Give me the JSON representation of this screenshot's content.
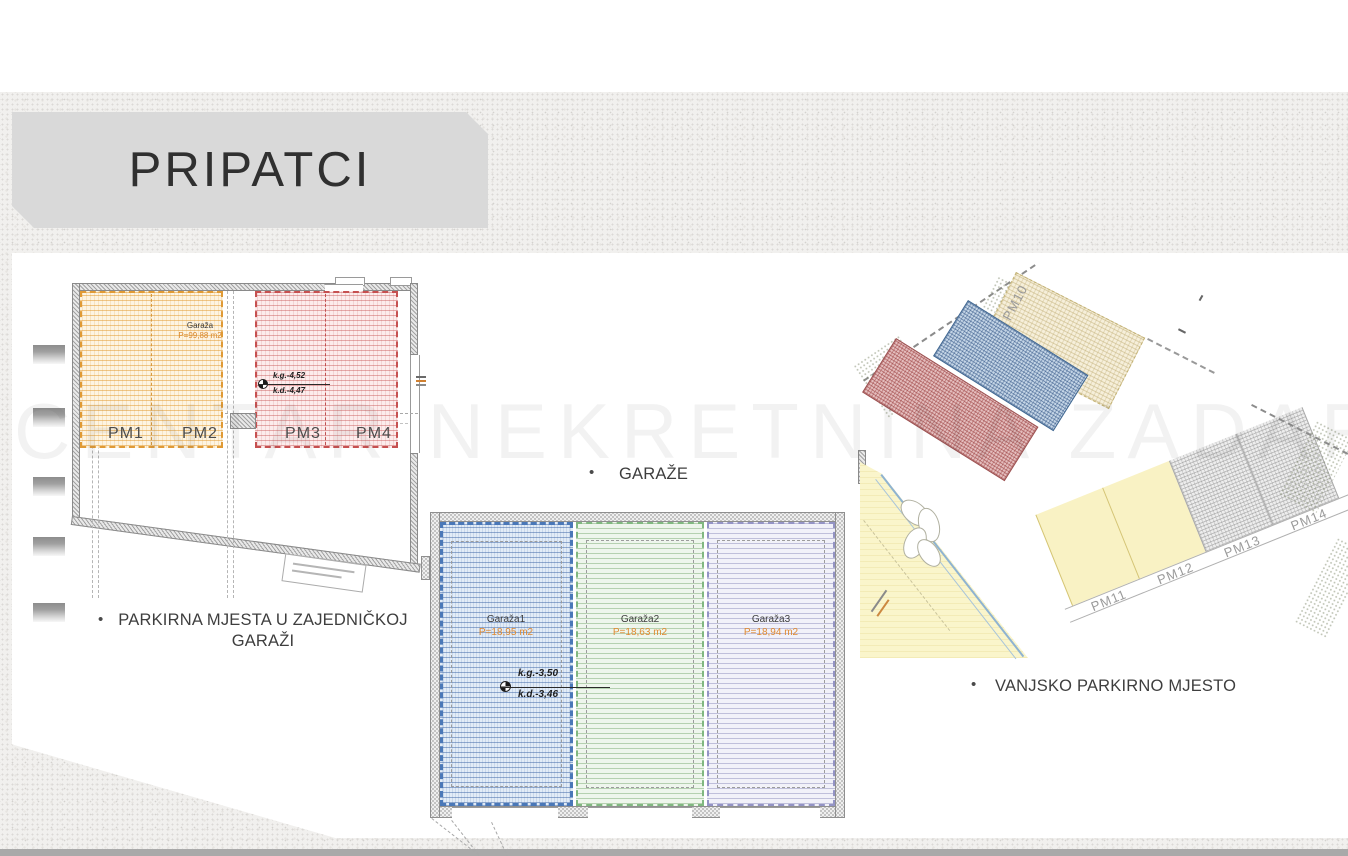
{
  "slide": {
    "title": "PRIPATCI",
    "watermark": "CENTAR NEKRETNINA ZADAR",
    "bullets": [
      {
        "label": "PARKIRNA MJESTA U ZAJEDNIČKOJ GARAŽI"
      },
      {
        "label": "GARAŽE"
      },
      {
        "label": "VANJSKO PARKIRNO MJESTO"
      }
    ]
  },
  "plans": {
    "shared_garage": {
      "name_label": "Garaža",
      "area_label": "P=99,88 m2",
      "level_top": "k.g.-4,52",
      "level_bottom": "k.d.-4,47",
      "stalls": [
        "PM1",
        "PM2",
        "PM3",
        "PM4"
      ]
    },
    "garages": {
      "units": [
        {
          "name": "Garaža1",
          "area": "P=18,95 m2"
        },
        {
          "name": "Garaža2",
          "area": "P=18,63 m2"
        },
        {
          "name": "Garaža3",
          "area": "P=18,94 m2"
        }
      ],
      "level_top": "k.g.-3,50",
      "level_bottom": "k.d.-3,46"
    },
    "outdoor": {
      "stalls": [
        "PM10",
        "PM11",
        "PM12",
        "PM13",
        "PM14"
      ]
    }
  },
  "colors": {
    "title_bg": "#d9d9d9",
    "zone_orange": "#e09a35",
    "zone_red": "#c65050",
    "zone_blue": "#4a78b8",
    "zone_green": "#80b880",
    "zone_lavender": "#9393c5",
    "site_yellow": "#faf5cb",
    "site_cream": "#f6efda",
    "site_blue": "#c4d5e6",
    "site_red": "#e4bdbd"
  }
}
